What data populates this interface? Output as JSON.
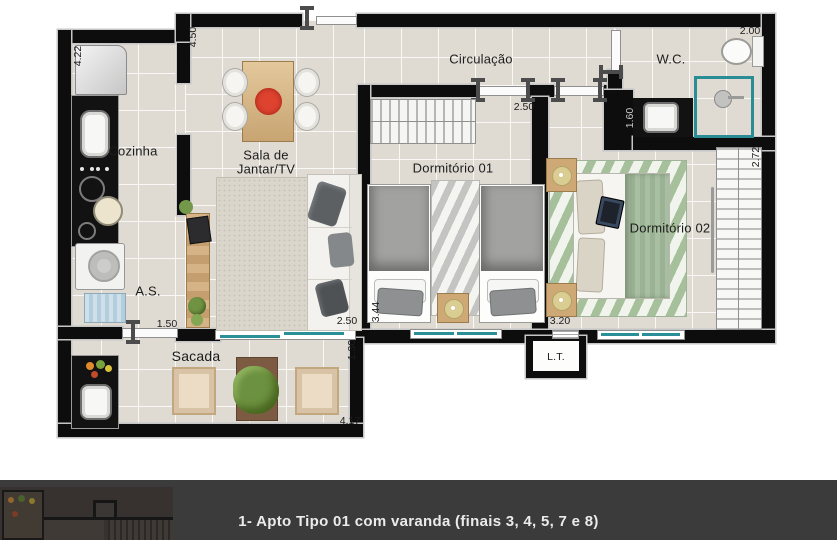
{
  "plan": {
    "rooms": {
      "circulacao": "Circulação",
      "wc": "W.C.",
      "cozinha": "Cozinha",
      "sala_line1": "Sala de",
      "sala_line2": "Jantar/TV",
      "dorm1": "Dormitório 01",
      "dorm2": "Dormitório 02",
      "as": "A.S.",
      "sacada": "Sacada",
      "lt": "L.T."
    },
    "dimensions": {
      "kitchen_depth": "4.22",
      "entry_wall": "4.50",
      "dorm1_width": "2.50",
      "wc_width": "2.00",
      "wc_depth": "1.60",
      "dorm2_depth": "2.72",
      "dorm1_depth": "3.44",
      "dorm2_width": "3.20",
      "sala_width": "2.50",
      "as_width": "1.50",
      "sacada_depth": "1.30",
      "sacada_width": "4.17"
    },
    "colors": {
      "wall": "#0d0d0d",
      "floor_tile": "#dfdbd3",
      "window_accent": "#2b8f98",
      "rug_green": "#a6c09c",
      "rug_gray": "#c4c4c2",
      "wood": "#cfa975",
      "footer_bg": "#3b3b3b"
    }
  },
  "footer": {
    "caption": "1- Apto Tipo 01 com varanda (finais 3, 4, 5, 7 e 8)"
  }
}
